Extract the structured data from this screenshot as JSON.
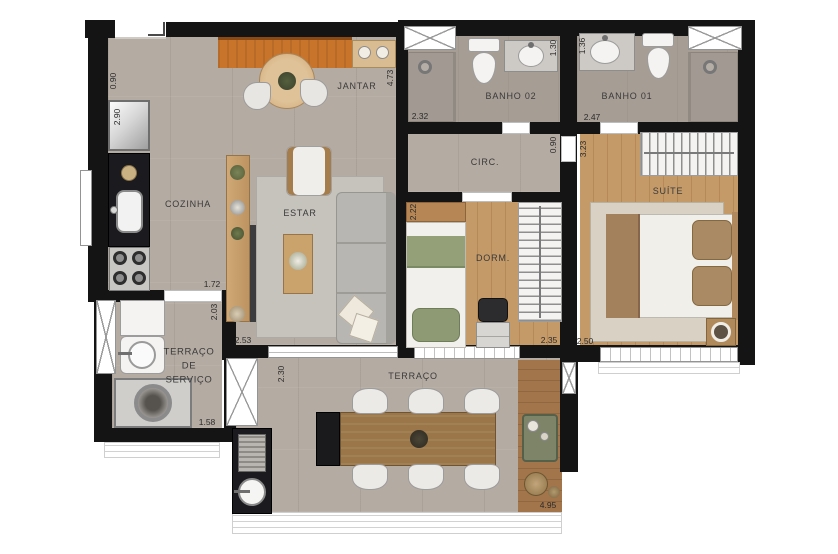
{
  "title": "apartment-floor-plan",
  "rooms": {
    "jantar": "JANTAR",
    "banho02": "BANHO 02",
    "banho01": "BANHO 01",
    "cozinha": "COZINHA",
    "estar": "ESTAR",
    "circ": "CIRC.",
    "dorm": "DORM.",
    "suite": "SUÍTE",
    "servico_l1": "TERRAÇO",
    "servico_l2": "DE",
    "servico_l3": "SERVIÇO",
    "terraco": "TERRAÇO"
  },
  "dimensions": {
    "entry_width": "0.90",
    "kitchen_top": "2.90",
    "jantar_wall": "4.73",
    "banho02_shower": "2.32",
    "banho02_width": "1.30",
    "banho01_width": "1.36",
    "banho01_length": "2.47",
    "circ_width": "0.90",
    "suite_length": "3.23",
    "dorm_height": "2.22",
    "cozinha_width": "1.72",
    "servico_height": "2.03",
    "estar_width": "2.53",
    "dorm_width": "2.35",
    "suite_width": "2.50",
    "servico_width": "1.58",
    "terraco_height": "2.30",
    "terraco_width": "4.95"
  },
  "palette": {
    "wall": "#141414",
    "floor_tile": "#b4aba2",
    "floor_bath": "#a69d95",
    "floor_wood": "#c49a69",
    "floor_wood_dark": "#b58a58",
    "deck_wood": "#a2754a",
    "buffet_orange": "#c8742b",
    "counter_black": "#1b1b1f",
    "rug_gray": "#c6c2bc",
    "rug_suite": "#d8d1c4",
    "sofa_gray": "#b7b6b3",
    "bed_green": "#93a078",
    "pillow_brown": "#a98a64",
    "furniture_wood": "#c9a36b",
    "terrace_table": "#9b7648",
    "white_fixture": "#f4f3f1",
    "label": "#3a3a3a",
    "dim": "#2b2b2b"
  }
}
